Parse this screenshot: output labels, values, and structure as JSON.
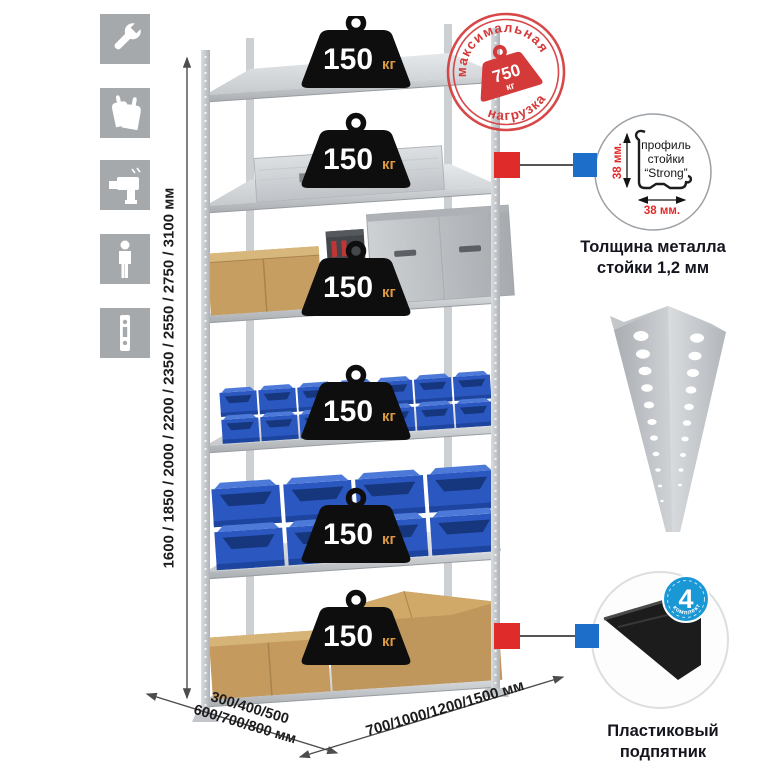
{
  "icons": {
    "left_column": [
      "wrench-icon",
      "gloves-icon",
      "drill-icon",
      "person-icon",
      "profile-strip-icon"
    ]
  },
  "dimensions": {
    "height": "1600 / 1850 / 2000 / 2200 / 2350 / 2550 / 2750 / 3100 мм",
    "depth_line1": "300/400/500",
    "depth_line2": "600/700/800 мм",
    "width": "700/1000/1200/1500 мм"
  },
  "stamp": {
    "arc_top": "максимальная",
    "arc_bottom": "нагрузка",
    "weight_value": "750",
    "weight_unit": "кг"
  },
  "shelf_badges": [
    {
      "value": "150",
      "unit": "кг"
    },
    {
      "value": "150",
      "unit": "кг"
    },
    {
      "value": "150",
      "unit": "кг"
    },
    {
      "value": "150",
      "unit": "кг"
    },
    {
      "value": "150",
      "unit": "кг"
    },
    {
      "value": "150",
      "unit": "кг"
    }
  ],
  "profile_detail": {
    "line1": "профиль",
    "line2": "стойки",
    "line3": "“Strong”",
    "dim_v": "38 мм.",
    "dim_h": "38 мм.",
    "caption": "Толщина металла стойки 1,2 мм"
  },
  "foot_detail": {
    "badge_value": "4",
    "badge_ring_text": "в комплекте",
    "caption": "Пластиковый подпятник"
  },
  "colors": {
    "stamp_red": "#d43a3a",
    "connector_red": "#e02b2b",
    "connector_blue": "#1d6ec8",
    "badge_black": "#0e0e0e",
    "badge_unit_orange": "#dd9a45",
    "bin_blue": "#2b57c0",
    "cardboard": "#c49a5f",
    "metal_gray": "#c7cbcf",
    "icon_gray": "#a6a9ac",
    "kit_badge_blue": "#1a97d5"
  }
}
